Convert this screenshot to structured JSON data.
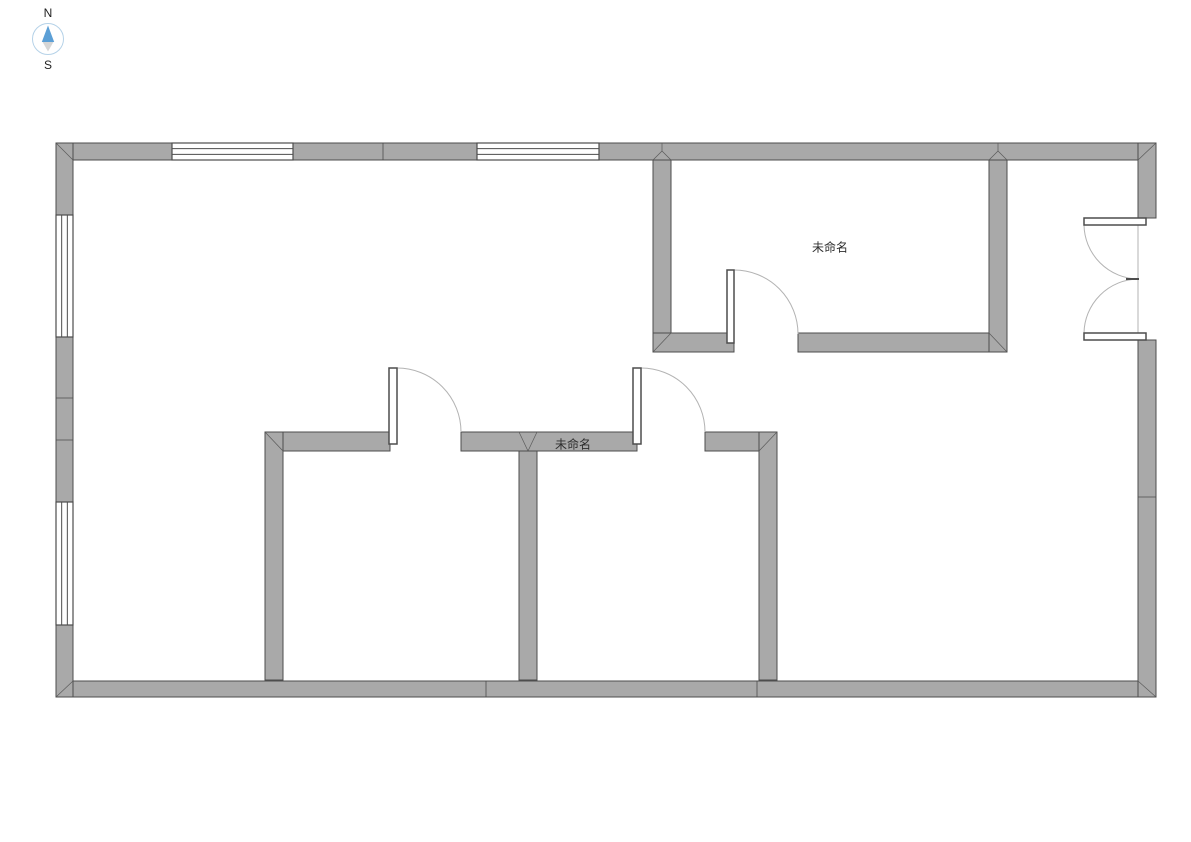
{
  "compass": {
    "north": "N",
    "south": "S"
  },
  "labels": [
    {
      "text": "未命名",
      "x": 830,
      "y": 247
    },
    {
      "text": "未命名",
      "x": 573,
      "y": 444
    }
  ],
  "colors": {
    "background": "#ffffff",
    "wall_fill": "#a9a9a9",
    "wall_stroke": "#4d4d4d",
    "miter_stroke": "#5a5a5a",
    "arc_stroke": "#b3b3b3",
    "leaf_fill": "#ffffff",
    "text": "#2e2e2e",
    "compass_needle_north": "#5b9fd6",
    "compass_needle_south": "#d6d6d6",
    "compass_ring": "#b5d2e8"
  },
  "plan": {
    "canvas": {
      "width": 1191,
      "height": 842
    },
    "walls": [
      {
        "name": "top-wall-left",
        "x": 56,
        "y": 143,
        "w": 116,
        "h": 17
      },
      {
        "name": "top-wall-mid",
        "x": 293,
        "y": 143,
        "w": 184,
        "h": 17
      },
      {
        "name": "top-wall-right",
        "x": 599,
        "y": 143,
        "w": 557,
        "h": 17
      },
      {
        "name": "bottom-wall",
        "x": 56,
        "y": 681,
        "w": 1100,
        "h": 16
      },
      {
        "name": "left-wall-upper",
        "x": 56,
        "y": 143,
        "w": 17,
        "h": 72
      },
      {
        "name": "left-wall-mid",
        "x": 56,
        "y": 337,
        "w": 17,
        "h": 165
      },
      {
        "name": "left-wall-lower",
        "x": 56,
        "y": 625,
        "w": 17,
        "h": 72
      },
      {
        "name": "right-wall-upper",
        "x": 1138,
        "y": 143,
        "w": 18,
        "h": 75
      },
      {
        "name": "right-wall-lower",
        "x": 1138,
        "y": 340,
        "w": 18,
        "h": 357
      },
      {
        "name": "room1-left-wall",
        "x": 653,
        "y": 160,
        "w": 18,
        "h": 192
      },
      {
        "name": "room1-bottom-wall-left",
        "x": 653,
        "y": 333,
        "w": 81,
        "h": 19
      },
      {
        "name": "room1-bottom-wall-right",
        "x": 798,
        "y": 333,
        "w": 209,
        "h": 19
      },
      {
        "name": "room1-right-wall",
        "x": 989,
        "y": 160,
        "w": 18,
        "h": 192
      },
      {
        "name": "mid-wall-left",
        "x": 265,
        "y": 432,
        "w": 125,
        "h": 19
      },
      {
        "name": "mid-wall-center",
        "x": 461,
        "y": 432,
        "w": 176,
        "h": 19
      },
      {
        "name": "mid-wall-right",
        "x": 705,
        "y": 432,
        "w": 72,
        "h": 19
      },
      {
        "name": "room2-left-wall",
        "x": 265,
        "y": 432,
        "w": 18,
        "h": 248
      },
      {
        "name": "rooms-divider-wall",
        "x": 519,
        "y": 451,
        "w": 18,
        "h": 229
      },
      {
        "name": "room3-right-wall",
        "x": 759,
        "y": 432,
        "w": 18,
        "h": 248
      }
    ],
    "windows": [
      {
        "name": "window-top-1",
        "x": 172,
        "y": 143,
        "w": 121,
        "h": 17,
        "dir": "h"
      },
      {
        "name": "window-top-2",
        "x": 477,
        "y": 143,
        "w": 122,
        "h": 17,
        "dir": "h"
      },
      {
        "name": "window-left-1",
        "x": 56,
        "y": 215,
        "w": 17,
        "h": 122,
        "dir": "v"
      },
      {
        "name": "window-left-2",
        "x": 56,
        "y": 502,
        "w": 17,
        "h": 123,
        "dir": "v"
      }
    ],
    "door_leaves": [
      {
        "name": "door-leaf-room2",
        "x": 389,
        "y": 368,
        "w": 8,
        "h": 76
      },
      {
        "name": "door-leaf-room3",
        "x": 633,
        "y": 368,
        "w": 8,
        "h": 76
      },
      {
        "name": "door-leaf-room1",
        "x": 727,
        "y": 270,
        "w": 7,
        "h": 73
      },
      {
        "name": "double-door-leaf-top",
        "x": 1084,
        "y": 218,
        "w": 62,
        "h": 7
      },
      {
        "name": "double-door-leaf-bottom",
        "x": 1084,
        "y": 333,
        "w": 62,
        "h": 7
      }
    ],
    "door_arcs": [
      {
        "name": "door-arc-room2",
        "d": "M 397 368 A 64 64 0 0 1 461 432"
      },
      {
        "name": "door-arc-room3",
        "d": "M 641 368 A 64 64 0 0 1 705 432"
      },
      {
        "name": "door-arc-room1",
        "d": "M 734 270 A 64 64 0 0 1 798 334"
      },
      {
        "name": "double-door-arc-top",
        "d": "M 1084 225 A 55 55 0 0 0 1138 279"
      },
      {
        "name": "double-door-arc-bottom",
        "d": "M 1084 333 A 55 55 0 0 1 1138 279"
      }
    ],
    "door_extras": [
      {
        "name": "double-door-frame-line",
        "x1": 1138,
        "y1": 225,
        "x2": 1138,
        "y2": 333,
        "kind": "light",
        "width": 1
      },
      {
        "name": "double-door-meet-dash",
        "x1": 1126,
        "y1": 279,
        "x2": 1139,
        "y2": 279,
        "kind": "dark",
        "width": 2
      }
    ],
    "segment_lines": [
      {
        "name": "top-wall-joint",
        "x1": 383,
        "y1": 143,
        "x2": 383,
        "y2": 160
      },
      {
        "name": "bottom-wall-joint-1",
        "x1": 486,
        "y1": 681,
        "x2": 486,
        "y2": 697
      },
      {
        "name": "bottom-wall-joint-2",
        "x1": 757,
        "y1": 681,
        "x2": 757,
        "y2": 697
      },
      {
        "name": "left-wall-joint-1",
        "x1": 56,
        "y1": 398,
        "x2": 73,
        "y2": 398
      },
      {
        "name": "left-wall-joint-2",
        "x1": 56,
        "y1": 440,
        "x2": 73,
        "y2": 440
      },
      {
        "name": "right-wall-joint",
        "x1": 1138,
        "y1": 497,
        "x2": 1156,
        "y2": 497
      }
    ],
    "miter_lines": [
      {
        "name": "corner-top-left",
        "x1": 56,
        "y1": 143,
        "x2": 73,
        "y2": 160
      },
      {
        "name": "corner-top-right",
        "x1": 1156,
        "y1": 143,
        "x2": 1138,
        "y2": 160
      },
      {
        "name": "corner-bottom-left",
        "x1": 56,
        "y1": 697,
        "x2": 73,
        "y2": 681
      },
      {
        "name": "corner-bottom-right",
        "x1": 1156,
        "y1": 697,
        "x2": 1138,
        "y2": 681
      },
      {
        "name": "room1-corner-left",
        "x1": 653,
        "y1": 352,
        "x2": 671,
        "y2": 333
      },
      {
        "name": "room1-corner-right",
        "x1": 1007,
        "y1": 352,
        "x2": 989,
        "y2": 333
      },
      {
        "name": "mid-corner-left",
        "x1": 265,
        "y1": 432,
        "x2": 283,
        "y2": 451
      },
      {
        "name": "mid-corner-right",
        "x1": 777,
        "y1": 432,
        "x2": 759,
        "y2": 451
      },
      {
        "name": "tjoint-room1-left-a",
        "x1": 653,
        "y1": 160,
        "x2": 662,
        "y2": 151
      },
      {
        "name": "tjoint-room1-left-b",
        "x1": 671,
        "y1": 160,
        "x2": 662,
        "y2": 151
      },
      {
        "name": "tjoint-room1-left-c",
        "x1": 662,
        "y1": 151,
        "x2": 662,
        "y2": 143
      },
      {
        "name": "tjoint-room1-right-a",
        "x1": 989,
        "y1": 160,
        "x2": 998,
        "y2": 151
      },
      {
        "name": "tjoint-room1-right-b",
        "x1": 1007,
        "y1": 160,
        "x2": 998,
        "y2": 151
      },
      {
        "name": "tjoint-room1-right-c",
        "x1": 998,
        "y1": 151,
        "x2": 998,
        "y2": 143
      },
      {
        "name": "tjoint-divider-a",
        "x1": 519,
        "y1": 432,
        "x2": 528,
        "y2": 451
      },
      {
        "name": "tjoint-divider-b",
        "x1": 537,
        "y1": 432,
        "x2": 528,
        "y2": 451
      }
    ]
  }
}
